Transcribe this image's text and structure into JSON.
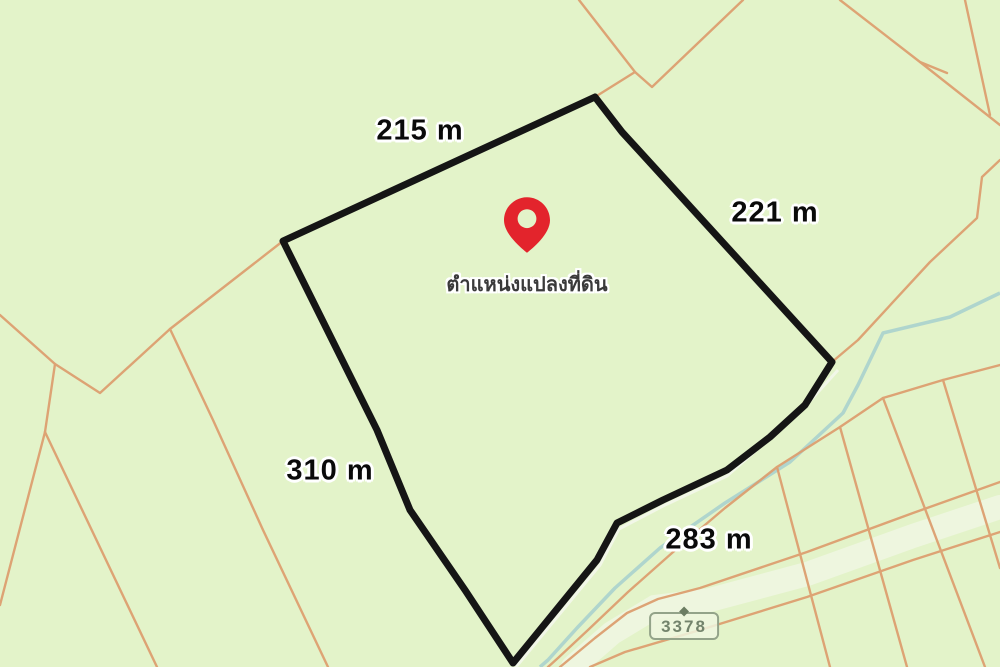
{
  "map": {
    "type": "land-parcel-map",
    "background_color": "#e3f3c9",
    "parcel_outline_color": "#151515",
    "boundary_line_color": "#dd9f70",
    "stream_color": "#afd5cd",
    "highway_fill_color": "#eef6df",
    "pin_color": "#e3242c",
    "label_halo_color": "#ffffff",
    "parcel": {
      "side_labels": {
        "top": "215 m",
        "right": "221 m",
        "left": "310 m",
        "bottom": "283 m"
      },
      "marker_label": "ตำแหน่งแปลงที่ดิน"
    },
    "route_shield": {
      "number": "3378"
    }
  }
}
